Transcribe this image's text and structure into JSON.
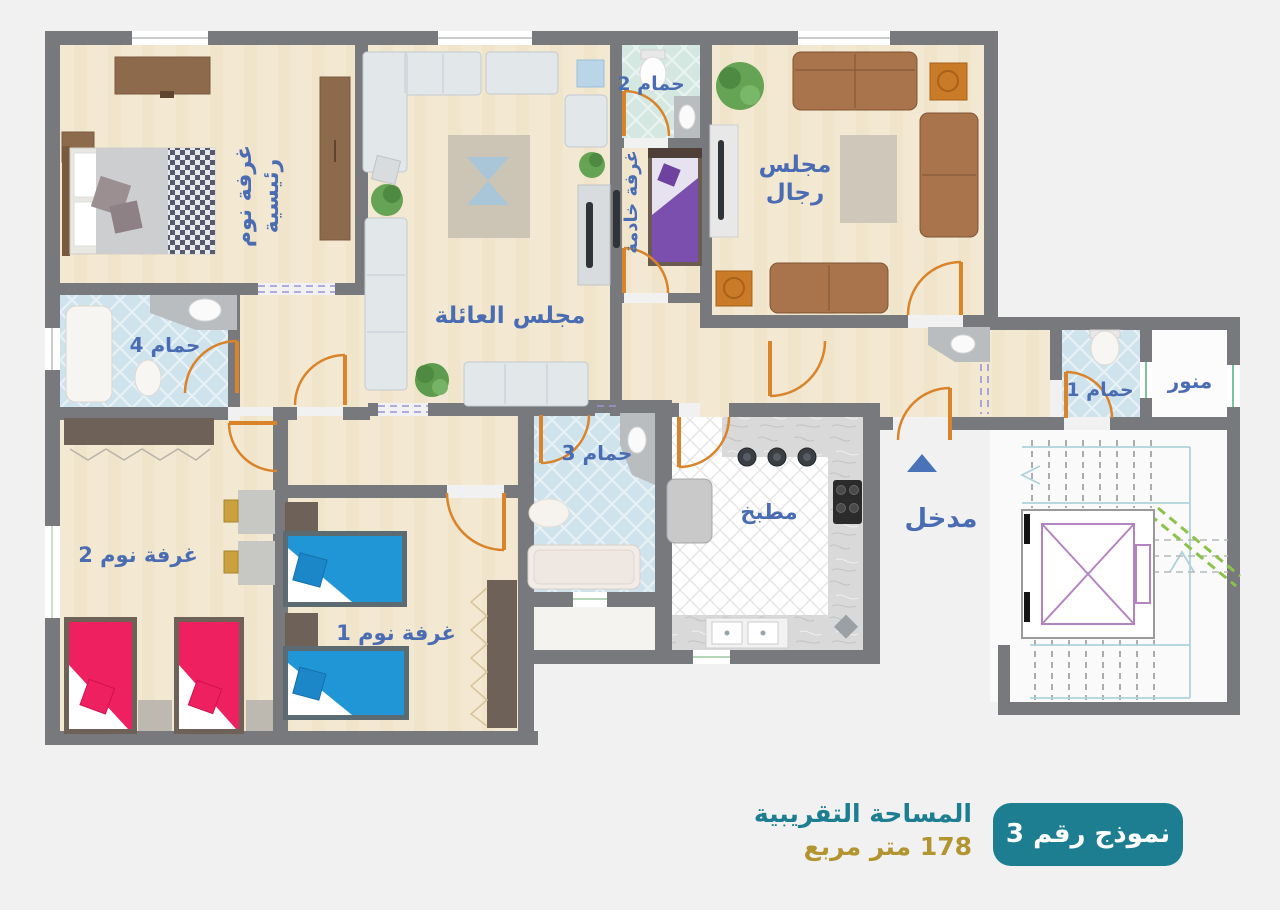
{
  "rooms": {
    "master_bedroom": {
      "label_line1": "غرفة نوم",
      "label_line2": "رئيسية"
    },
    "family_majlis": {
      "label": "مجلس العائلة"
    },
    "mens_majlis": {
      "label_line1": "مجلس",
      "label_line2": "رجال"
    },
    "maid_room": {
      "label": "غرفة خادمة"
    },
    "bathroom_1": {
      "label": "حمام 1"
    },
    "bathroom_2": {
      "label": "حمام 2"
    },
    "bathroom_3": {
      "label": "حمام 3"
    },
    "bathroom_4": {
      "label": "حمام 4"
    },
    "kitchen": {
      "label": "مطبخ"
    },
    "entrance": {
      "label": "مدخل"
    },
    "bedroom_1": {
      "label": "غرفة نوم 1"
    },
    "bedroom_2": {
      "label": "غرفة نوم 2"
    },
    "light_well": {
      "label": "منور"
    }
  },
  "footer": {
    "area_title": "المساحة التقريبية",
    "area_value": "178 متر مربع",
    "model_badge": "نموذج رقم 3"
  },
  "colors": {
    "label_blue": "#4a6cb3",
    "teal": "#1d7e91",
    "gold": "#b2952f",
    "wall_gray": "#77797c",
    "door_orange": "#d9842b",
    "bed_pink": "#ee2060",
    "bed_blue": "#2196d6",
    "bed_purple": "#7b4fae",
    "sofa_brown": "#a9744b",
    "bathroom_blue": "#cfe3ec"
  }
}
